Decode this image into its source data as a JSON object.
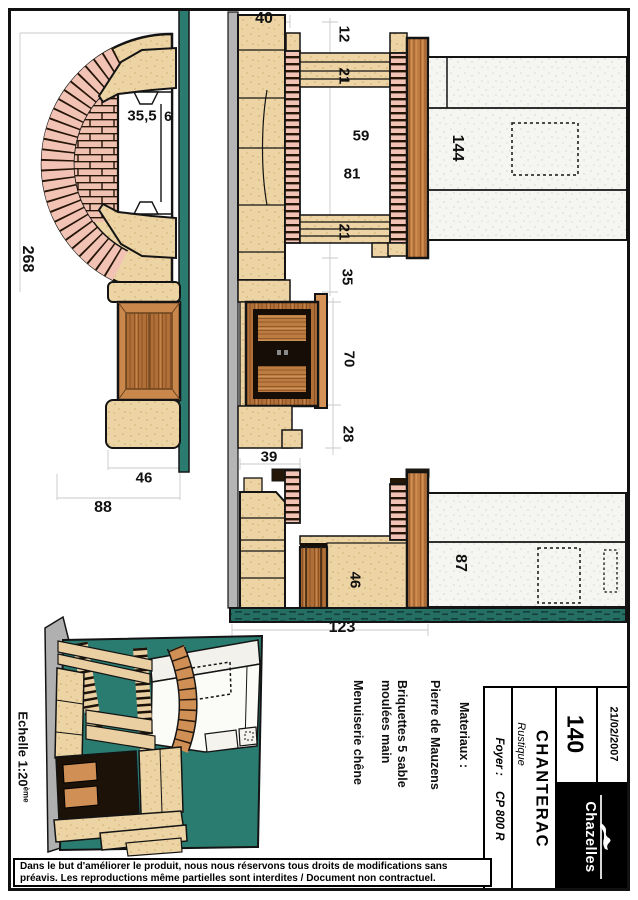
{
  "drawing": {
    "scale_note": {
      "text": "Echelle 1:20",
      "sup": "ème"
    },
    "dims": {
      "top_offset": "40",
      "plan_opening_width": "35,5",
      "plan_jamb": "6",
      "plan_total_height": "268",
      "seg_top": "12",
      "seg_lintel_top": "21",
      "opening_a": "59",
      "opening_b": "81",
      "seg_lintel_bottom": "21",
      "seg_hearth": "35",
      "block_height_upper": "144",
      "cabinet_height": "70",
      "base_gap": "28",
      "foot_width": "39",
      "hearth_depth": "46",
      "block_height_lower": "87",
      "base_width": "123",
      "bench_depth": "46",
      "bench_total": "88"
    },
    "materials": {
      "title": "Materiaux :",
      "line1": "Pierre de Mauzens",
      "line2": "Briquettes 5 sable",
      "line3": "moulées main",
      "line4": "Menuiserie chêne"
    }
  },
  "title_block": {
    "foyer_label": "Foyer :",
    "foyer_value": "CP 800 R",
    "style": "Rustique",
    "model": "CHANTERAC",
    "number": "140",
    "date": "21/02/2007",
    "brand": "Chazelles"
  },
  "disclaimer": {
    "line1": "Dans le but d'améliorer le produit, nous nous réservons tous droits de modifications sans",
    "line2": "préavis. Les reproductions même partielles sont interdites / Document non contractuel."
  },
  "colors": {
    "stone": "#ecd4a4",
    "brick": "#f2c3b4",
    "wood": "#b06f36",
    "teal": "#2a7c70",
    "grey_wall": "#b5b5b5"
  }
}
